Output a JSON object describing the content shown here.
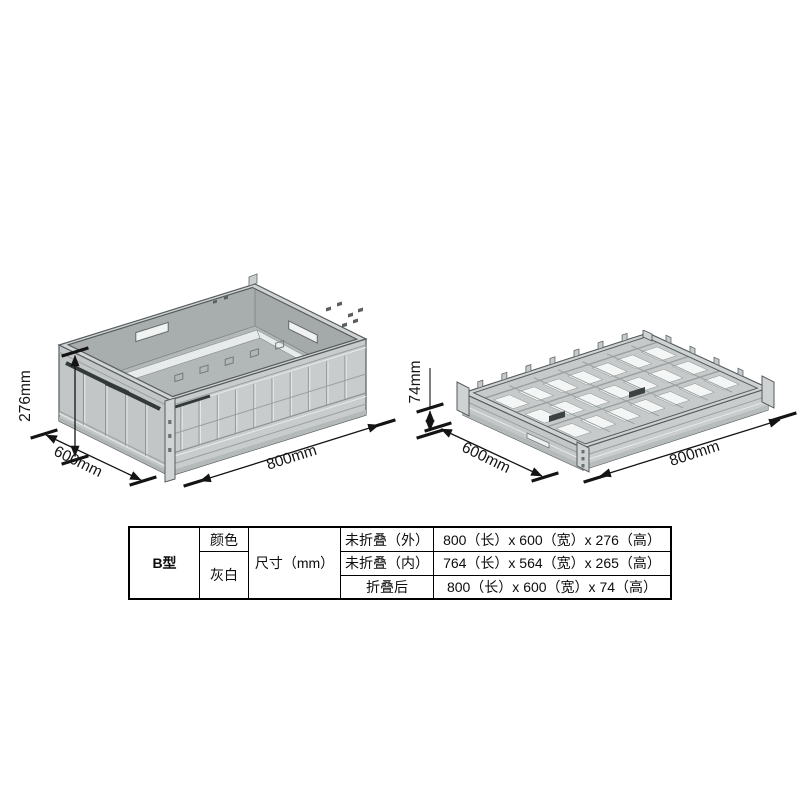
{
  "diagram": {
    "unfolded": {
      "height_label": "276mm",
      "width_label": "600mm",
      "length_label": "800mm"
    },
    "folded": {
      "height_label": "74mm",
      "width_label": "600mm",
      "length_label": "800mm"
    }
  },
  "table": {
    "model": "B型",
    "color_label": "颜色",
    "color_value": "灰白",
    "size_label": "尺寸（mm）",
    "rows": [
      {
        "state": "未折叠（外）",
        "dimensions": "800（长）x 600（宽）x 276（高）"
      },
      {
        "state": "未折叠（内）",
        "dimensions": "764（长）x 564（宽）x 265（高）"
      },
      {
        "state": "折叠后",
        "dimensions": "800（长）x 600（宽）x 74（高）"
      }
    ]
  },
  "colors": {
    "crate_fill": "#c6caca",
    "crate_outline": "#565b5d",
    "latch_dark": "#33383a",
    "dimension_ink": "#141414"
  }
}
